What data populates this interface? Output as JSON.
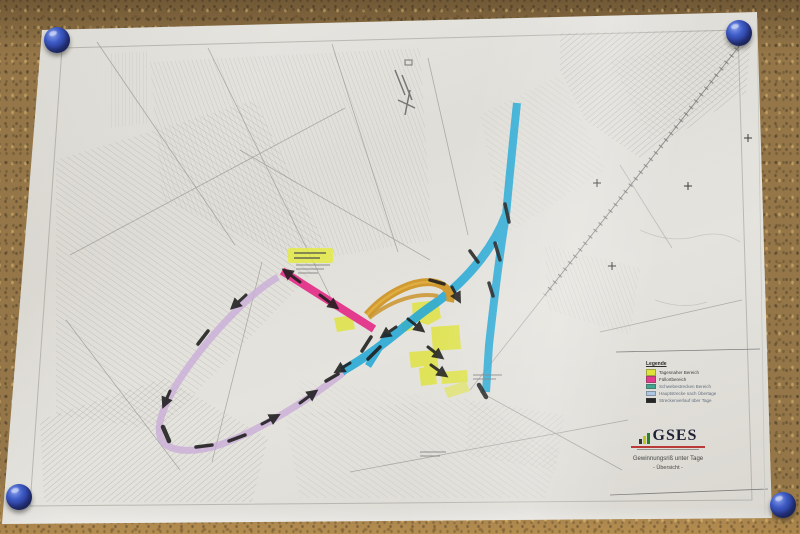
{
  "legend": {
    "title": "Legende",
    "items": [
      {
        "label": "Tagesnaher Bereich",
        "swatch": "#dde32e"
      },
      {
        "label": "Füllortbereich",
        "swatch": "#e23189"
      },
      {
        "label": "Schwebestrecken Bereich",
        "swatch": "#3aa089"
      },
      {
        "label": "Hauptstrecke nach Übertage",
        "swatch": "#a9c3e2"
      },
      {
        "label": "Streckenverlauf über Tage",
        "swatch": "#1a1a1a"
      }
    ]
  },
  "title_block": {
    "org_name": "GSES",
    "map_title": "Gewinnungsriß unter Tage",
    "map_subtitle": "- Übersicht -"
  },
  "colors": {
    "route_cyan": "#1ea6d4",
    "route_pink": "#e23189",
    "route_purple": "#c7a9d6",
    "route_orange": "#cd9526",
    "highlight_yellow": "#dde32e",
    "marker_black": "#111111",
    "pin_blue": "#2840a6",
    "cork_brown": "#8f6f3e"
  }
}
